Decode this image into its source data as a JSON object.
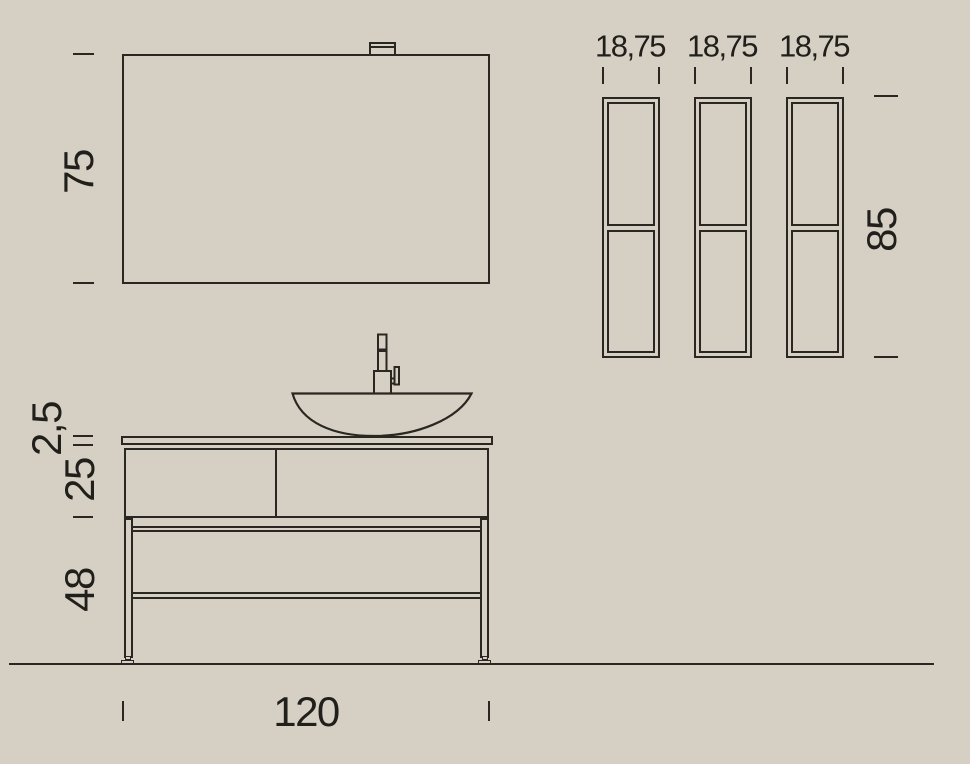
{
  "drawing": {
    "title": "bathroom-vanity-technical-drawing",
    "background": "#d5d0c3",
    "line_color": "#2a2722",
    "text_color": "#211f1b",
    "mirror": {
      "height_label": "75"
    },
    "columns": {
      "width_labels": [
        "18,75",
        "18,75",
        "18,75"
      ],
      "height_label": "85"
    },
    "vanity": {
      "counter_thickness_label": "2,5",
      "drawer_height_label": "25",
      "frame_height_label": "48",
      "width_label": "120"
    }
  }
}
